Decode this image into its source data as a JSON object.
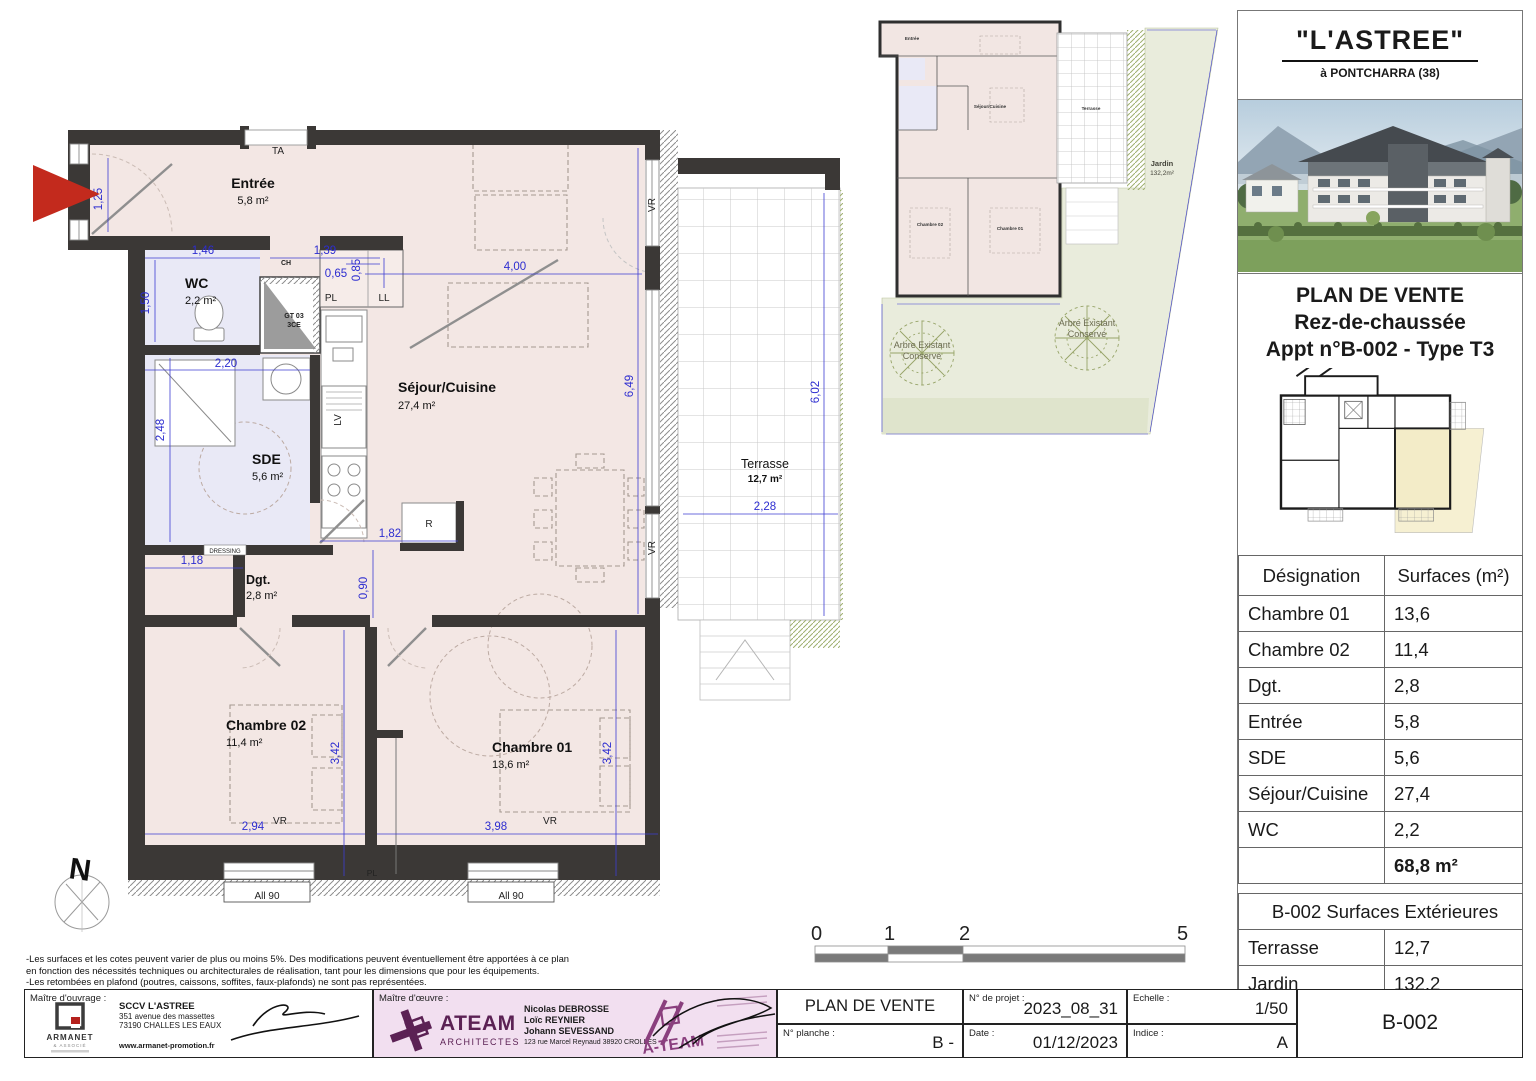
{
  "colors": {
    "floor_pink": "#f3e7e4",
    "floor_blue": "#e9e9f6",
    "wall_dark": "#3b3836",
    "dim_blue": "#2d2dd0",
    "garden_green": "#e9ecdc",
    "accent_purple": "#5b2154",
    "stamp_pink": "#f2dff0",
    "arrow_red": "#c32a1d",
    "highlight_yellow": "#f3ecc8"
  },
  "plan": {
    "rooms": {
      "entree": {
        "name": "Entrée",
        "area": "5,8 m²"
      },
      "wc": {
        "name": "WC",
        "area": "2,2 m²"
      },
      "sde": {
        "name": "SDE",
        "area": "5,6 m²"
      },
      "sejour": {
        "name": "Séjour/Cuisine",
        "area": "27,4 m²"
      },
      "dgt": {
        "name": "Dgt.",
        "area": "2,8 m²"
      },
      "ch02": {
        "name": "Chambre 02",
        "area": "11,4 m²"
      },
      "ch01": {
        "name": "Chambre 01",
        "area": "13,6 m²"
      },
      "terrasse": {
        "name": "Terrasse",
        "area": "12,7 m²"
      }
    },
    "dims": {
      "d125": "1,25",
      "d146": "1,46",
      "d139": "1,39",
      "d065": "0,65",
      "d085": "0,85",
      "d150": "1,50",
      "d220": "2,20",
      "d248": "2,48",
      "d400": "4,00",
      "d649": "6,49",
      "d118": "1,18",
      "d182": "1,82",
      "d090": "0,90",
      "d342": "3,42",
      "d294": "2,94",
      "d398": "3,98",
      "d602": "6,02",
      "d228": "2,28"
    },
    "labels": {
      "ta": "TA",
      "ch": "CH",
      "gt1": "GT 03",
      "gt2": "3CE",
      "pl": "PL",
      "ll": "LL",
      "lv": "LV",
      "r": "R",
      "dressing": "DRESSING",
      "vr": "VR",
      "all90": "All 90",
      "north": "N"
    },
    "scale": {
      "t0": "0",
      "t1": "1",
      "t2": "2",
      "t5": "5"
    }
  },
  "site": {
    "jardin_name": "Jardin",
    "jardin_area": "132,2m²",
    "tree_label_1": "Arbre Existant",
    "tree_label_2": "Conservé"
  },
  "sidebar": {
    "title": "\"L'ASTREE\"",
    "subtitle": "à PONTCHARRA (38)",
    "plan_title_1": "PLAN DE VENTE",
    "plan_title_2": "Rez-de-chaussée",
    "plan_title_3": "Appt n°B-002 - Type T3",
    "surfaces_table": {
      "header_designation": "Désignation",
      "header_surfaces": "Surfaces (m²)",
      "rows": [
        [
          "Chambre 01",
          "13,6"
        ],
        [
          "Chambre 02",
          "11,4"
        ],
        [
          "Dgt.",
          "2,8"
        ],
        [
          "Entrée",
          "5,8"
        ],
        [
          "SDE",
          "5,6"
        ],
        [
          "Séjour/Cuisine",
          "27,4"
        ],
        [
          "WC",
          "2,2"
        ]
      ],
      "total": "68,8 m²"
    },
    "exterior_table": {
      "title": "B-002 Surfaces Extérieures",
      "rows": [
        [
          "Terrasse",
          "12,7"
        ],
        [
          "Jardin",
          "132,2"
        ]
      ]
    }
  },
  "footer": {
    "disclaimer_1": "-Les surfaces et les cotes peuvent varier de plus ou moins 5%. Des modifications peuvent éventuellement être apportées à ce plan",
    "disclaimer_2": "en fonction des nécessités techniques ou architecturales de réalisation, tant pour les dimensions que pour les équipements.",
    "disclaimer_3": "-Les retombées en plafond (poutres, caissons, soffites, faux-plafonds) ne sont pas représentées.",
    "disclaimer_4": "-Les canalisations et radiateurs sont donnés à titre indicatif, mais ne sont pas contractuels. Des modifications peuvent y être apportées.",
    "moa_label": "Maître d'ouvrage :",
    "moa_company": "SCCV L'ASTREE",
    "moa_address_1": "351 avenue des massettes",
    "moa_address_2": "73190 CHALLES LES EAUX",
    "moa_website": "www.armanet-promotion.fr",
    "moa_logo": "ARMANET",
    "moa_logo_sub": "& ASSOCIÉ",
    "moe_label": "Maître d'œuvre :",
    "moe_logo": "ATEAM",
    "moe_logo_sub": "ARCHITECTES",
    "moe_name_1": "Nicolas DEBROSSE",
    "moe_name_2": "Loïc REYNIER",
    "moe_name_3": "Johann SEVESSAND",
    "moe_address": "123 rue Marcel Reynaud 38920 CROLLES",
    "moe_stamp": "A-TEAM",
    "doc_title": "PLAN DE VENTE",
    "planche_label": "N° planche :",
    "planche_value": "B -",
    "project_label": "N° de projet :",
    "project_value": "2023_08_31",
    "date_label": "Date :",
    "date_value": "01/12/2023",
    "scale_label": "Echelle :",
    "scale_value": "1/50",
    "indice_label": "Indice :",
    "indice_value": "A",
    "sheet": "B-002"
  }
}
